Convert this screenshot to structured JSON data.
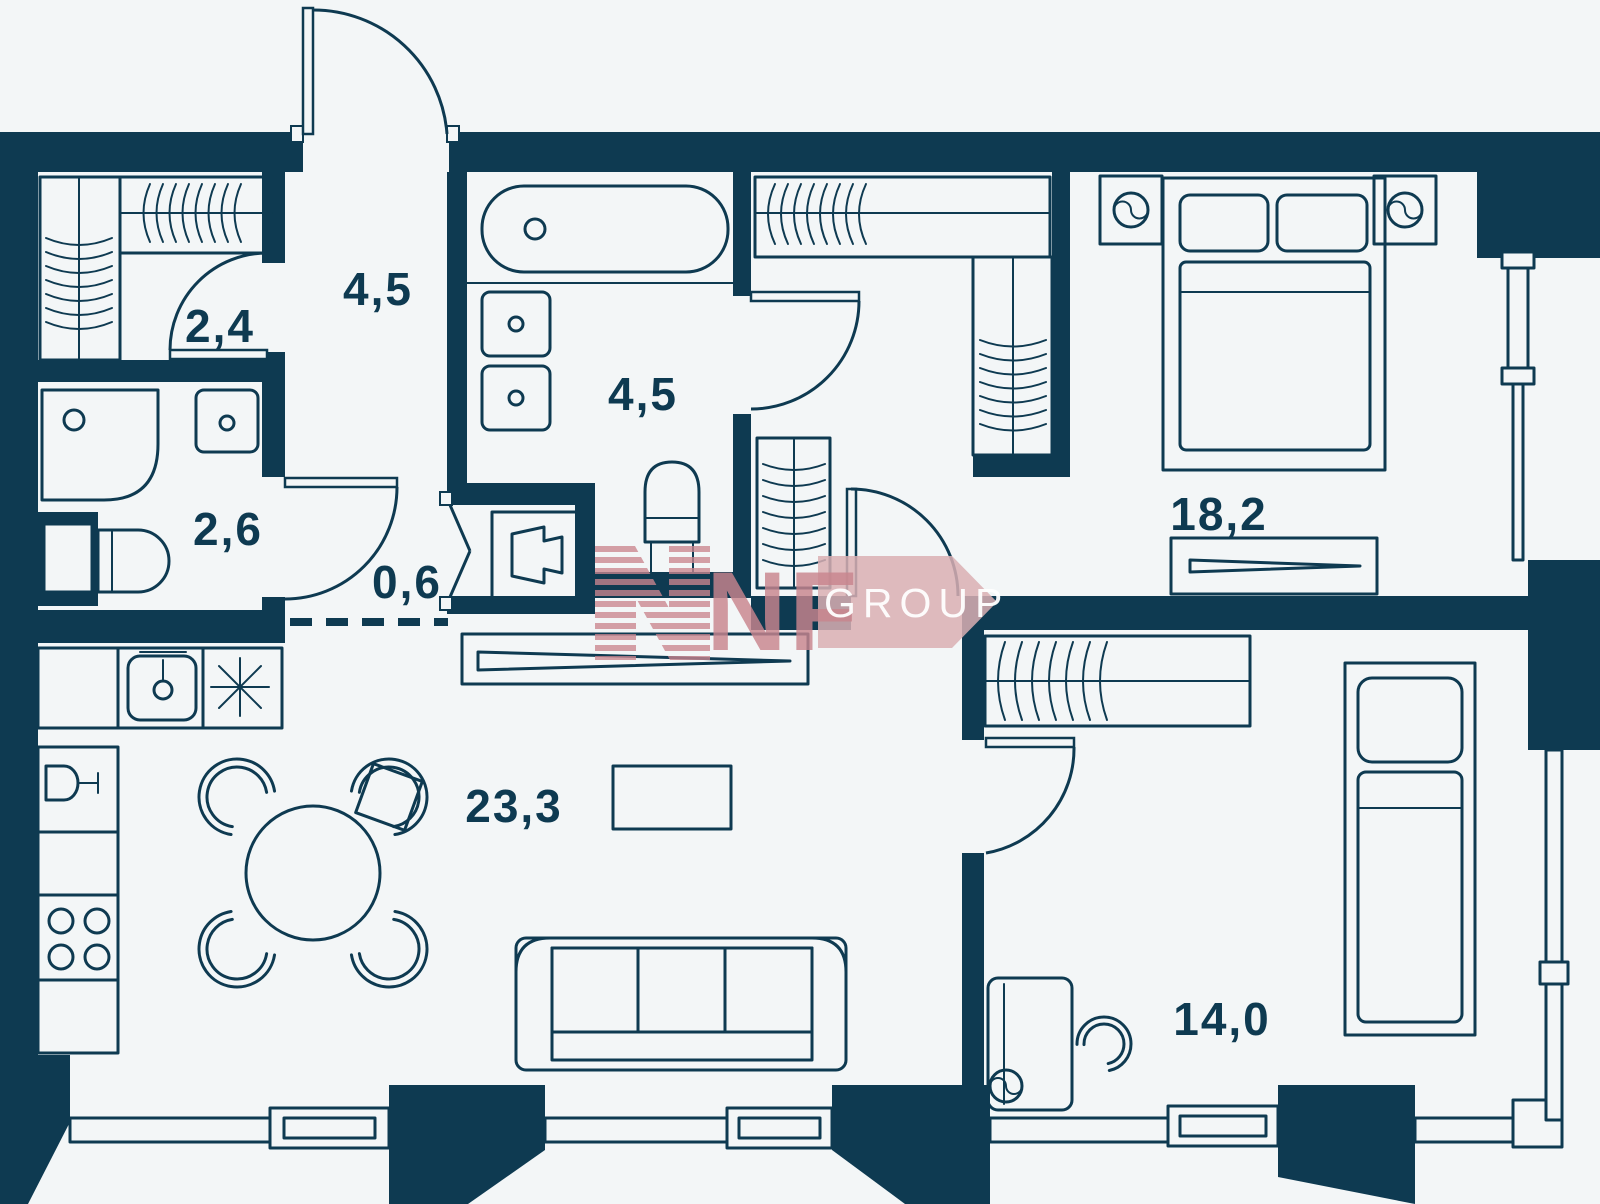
{
  "page": {
    "title": "Apartment floor plan"
  },
  "colors": {
    "background": "#f3f6f7",
    "wall": "#0e3a51",
    "watermark_pink": "#c9858e",
    "watermark_banner_pink": "#d9afb3",
    "watermark_text": "#ffffff"
  },
  "watermark": {
    "letters": "NF",
    "banner": "GROUP"
  },
  "rooms": [
    {
      "id": "closet",
      "name": "wardrobe-closet",
      "area": "2,4"
    },
    {
      "id": "entry-hall",
      "name": "entry-hall",
      "area": "4,5"
    },
    {
      "id": "shower-room",
      "name": "shower-room",
      "area": "2,6"
    },
    {
      "id": "corridor",
      "name": "corridor-niche",
      "area": "0,6"
    },
    {
      "id": "bathroom",
      "name": "bathroom",
      "area": "4,5"
    },
    {
      "id": "bedroom-main",
      "name": "main-bedroom",
      "area": "18,2"
    },
    {
      "id": "living-kitchen",
      "name": "living-kitchen",
      "area": "23,3"
    },
    {
      "id": "bedroom-second",
      "name": "second-bedroom",
      "area": "14,0"
    }
  ]
}
